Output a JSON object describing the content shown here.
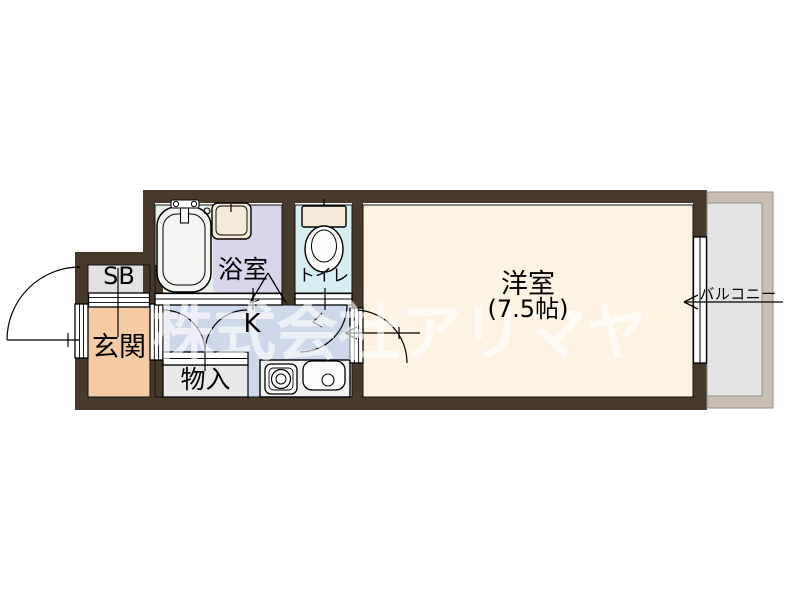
{
  "plan": {
    "type": "apartment-floor-plan",
    "rooms": {
      "entrance": {
        "label": "玄関"
      },
      "shoe_box": {
        "label": "SB"
      },
      "bathroom": {
        "label": "浴室"
      },
      "toilet": {
        "label": "トイレ"
      },
      "kitchen": {
        "label": "K"
      },
      "storage": {
        "label": "物入"
      },
      "main_room": {
        "label": "洋室",
        "size_label": "(7.5帖)",
        "size_jo": 7.5
      },
      "balcony": {
        "label": "バルコニー"
      }
    },
    "watermark": {
      "text": "株式会社アリマヤ"
    },
    "colors": {
      "wall": "#473a2b",
      "entrance_fill": "#f4cba3",
      "shoe_box_fill": "#e2e2e2",
      "bathtub_area_fill": "#eaf2ec",
      "bathroom_fill": "#d9d5ec",
      "toilet_fill": "#d8eff1",
      "kitchen_fill": "#cdd9eb",
      "storage_fill": "#e9e9e9",
      "main_room_fill": "#fdf3e3",
      "balcony_fill": "#e4e4e3",
      "balcony_frame": "#c9c0b1"
    }
  }
}
